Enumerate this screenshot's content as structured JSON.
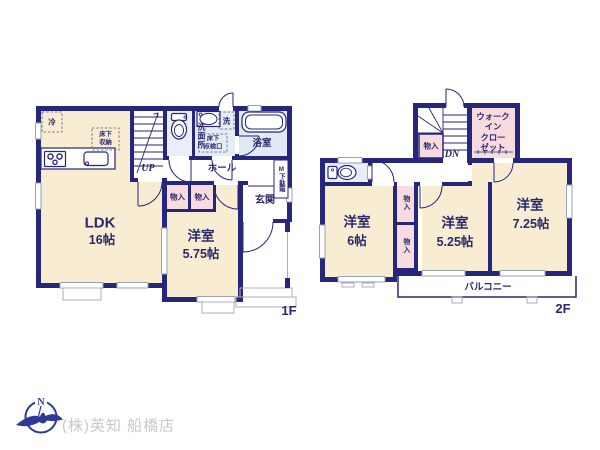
{
  "colors": {
    "wall": "#26267a",
    "room_cream": "#f8edd2",
    "closet_pink": "#f8dbde",
    "wet_blue": "#e4ecf6",
    "window_gray": "#9aa2b8",
    "label_navy": "#29296b",
    "logo_navy": "#2b3a94",
    "company_gray": "#c8c8c8"
  },
  "floor1": {
    "floor_label": "1F",
    "ldk": {
      "name": "LDK",
      "size": "16帖"
    },
    "bedroom": {
      "name": "洋室",
      "size": "5.75帖"
    },
    "hall": "ホール",
    "entrance": "玄関",
    "bathroom": "浴室",
    "washroom": "洗面所",
    "washer": "洗",
    "fridge": "冷",
    "underfloor_storage": "床下\n収納",
    "underfloor_hatch": "床下\n点検口",
    "shoe_cabinet": "M下駄箱",
    "closet_left": "物入",
    "closet_right": "物入",
    "stairs_label": "UP"
  },
  "floor2": {
    "floor_label": "2F",
    "bedroom_left": {
      "name": "洋室",
      "size": "6帖"
    },
    "bedroom_middle": {
      "name": "洋室",
      "size": "5.25帖"
    },
    "bedroom_right": {
      "name": "洋室",
      "size": "7.25帖"
    },
    "walk_in_closet": "ウォーク\nイン\nクロー\nゼット",
    "stair_closet": "物入",
    "closet_upper": "物入",
    "closet_lower": "物入",
    "balcony": "バルコニー",
    "stairs_label": "DN"
  },
  "footer": {
    "company": "(株)英知 船橋店",
    "logo_letter": "N"
  }
}
